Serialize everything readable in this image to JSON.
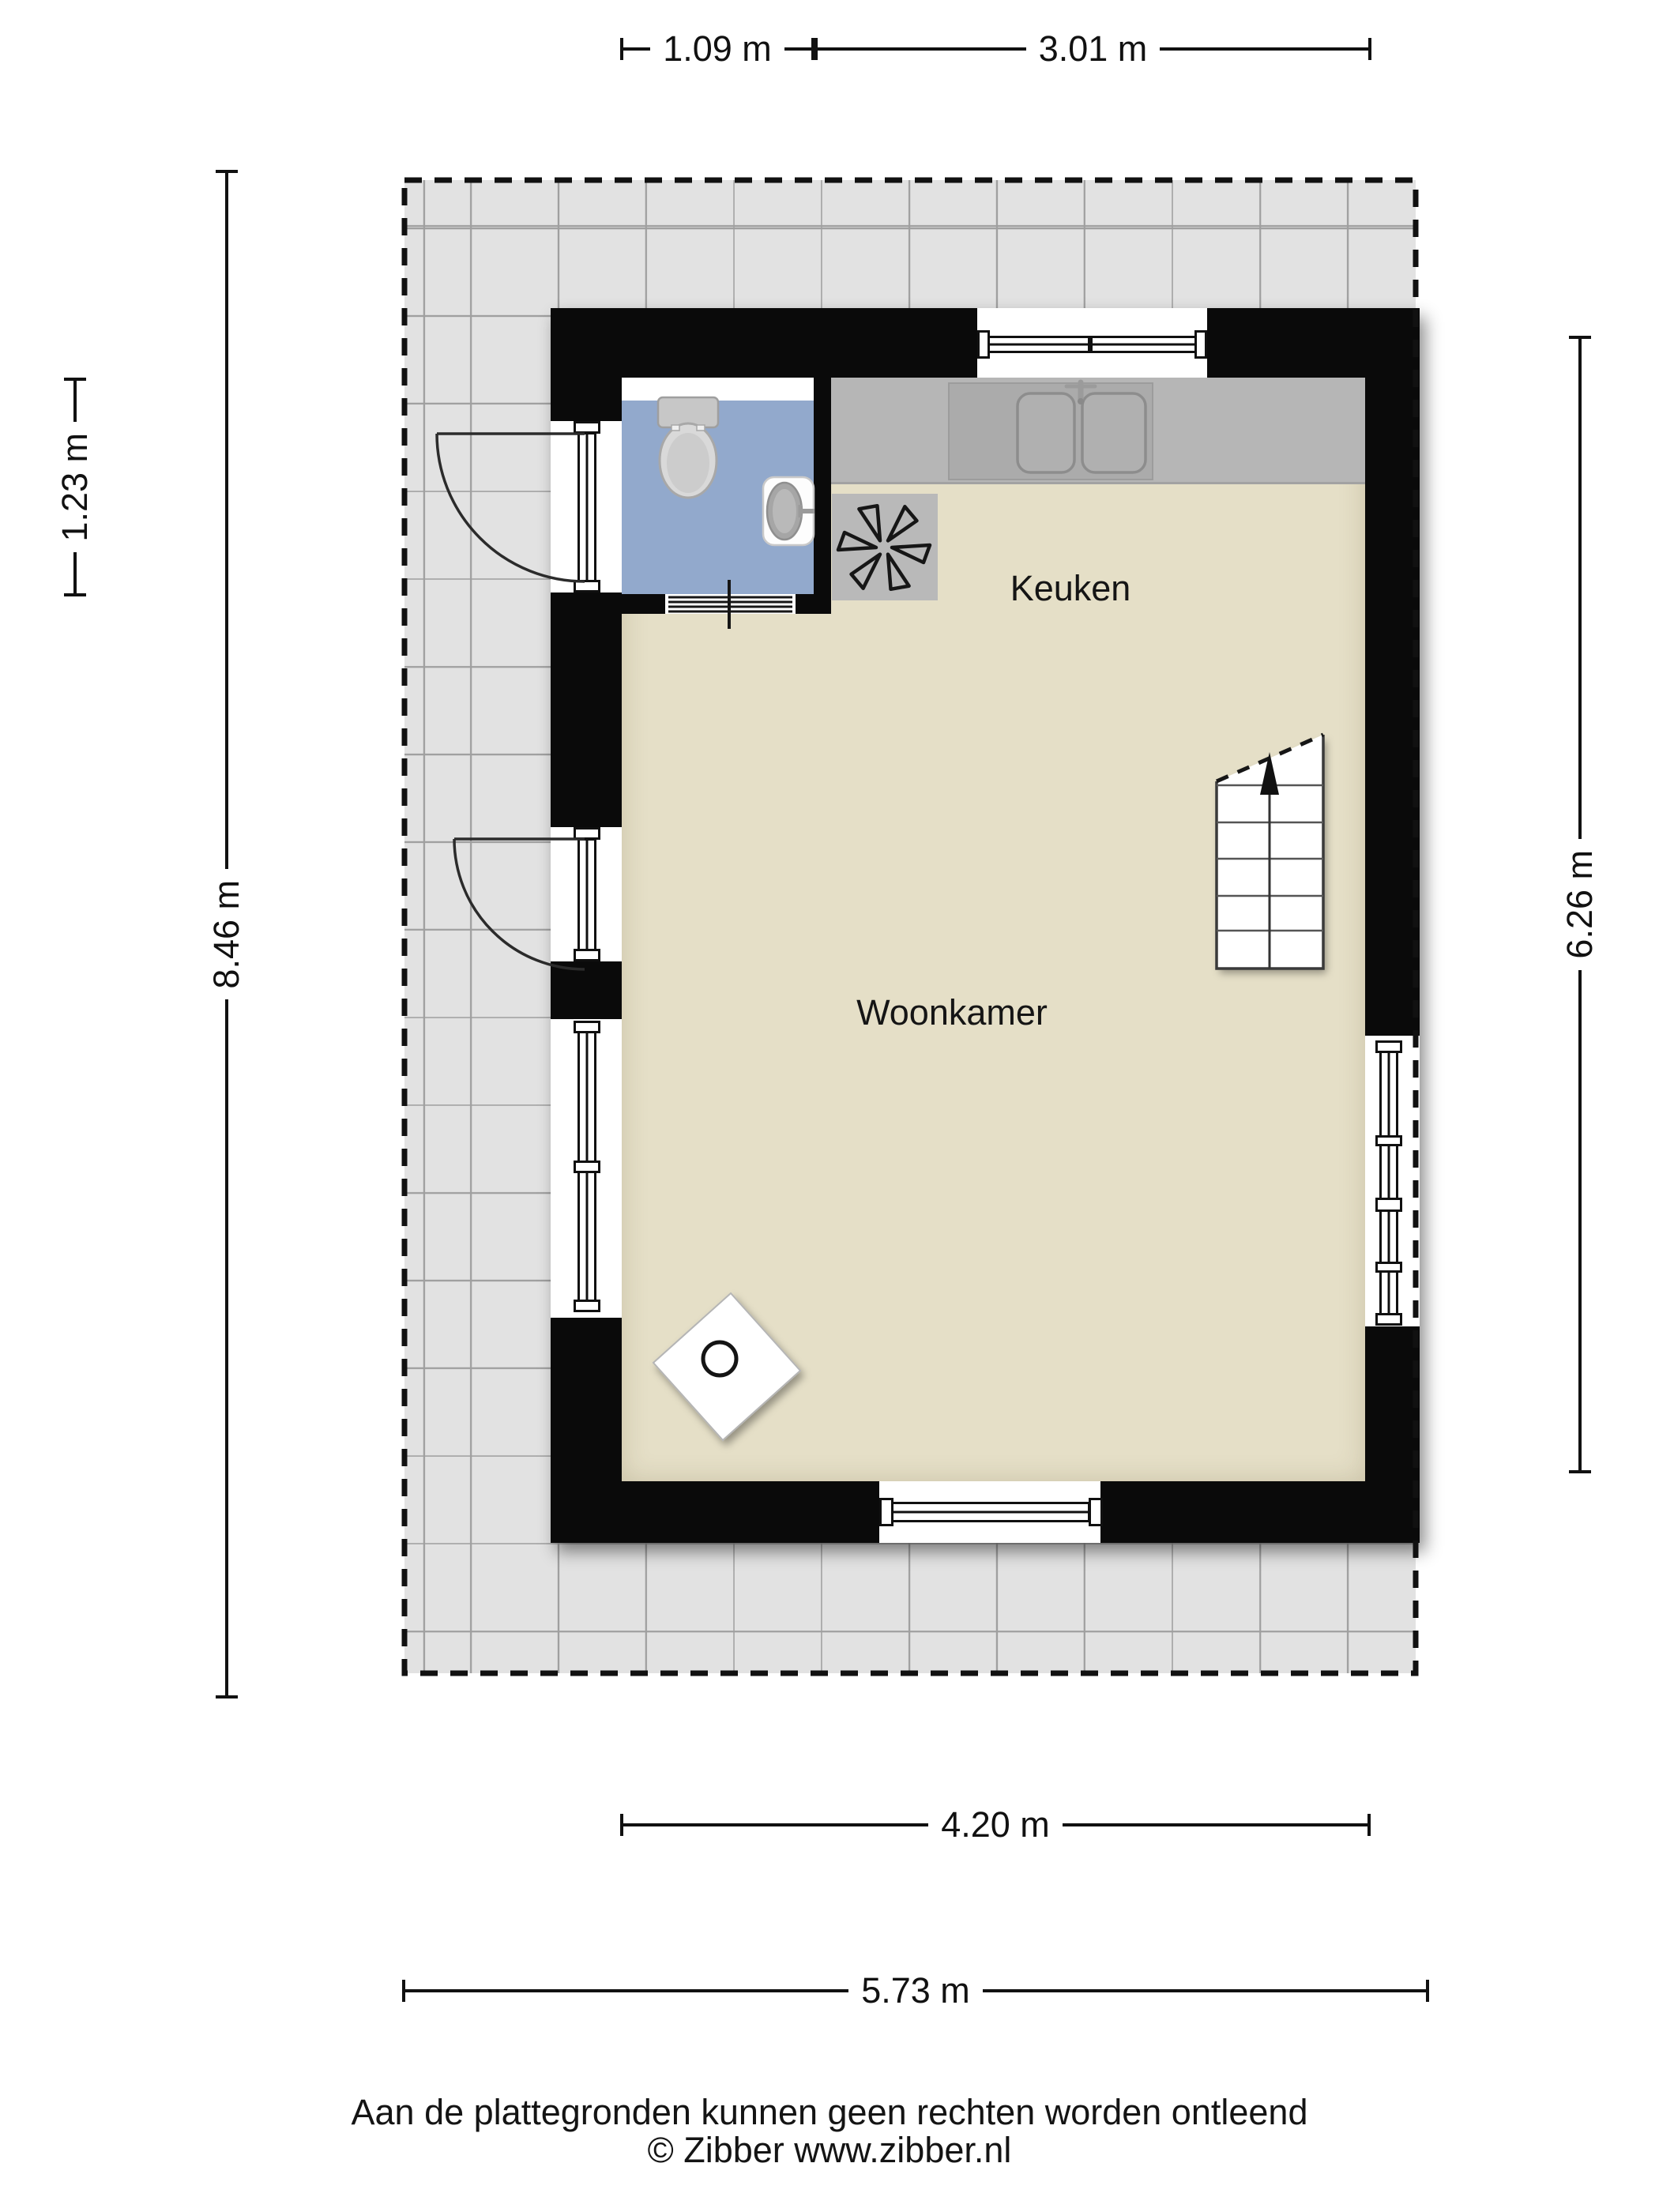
{
  "plan": {
    "type": "floorplan",
    "rooms": {
      "kitchen": "Keuken",
      "living_room": "Woonkamer"
    },
    "fixtures": [
      "toilet",
      "washbasin",
      "kitchen-sink",
      "extractor-fan",
      "stove",
      "staircase"
    ]
  },
  "dimensions": {
    "top_left": "1.09 m",
    "top_right": "3.01 m",
    "left_inner": "1.23 m",
    "left_outer": "8.46 m",
    "right": "6.26 m",
    "bottom_inner": "4.20 m",
    "bottom_outer": "5.73 m"
  },
  "footer": {
    "disclaimer": "Aan de plattegronden kunnen geen rechten worden ontleend",
    "copyright": "© Zibber www.zibber.nl"
  },
  "colors": {
    "wall": "#0a0a0a",
    "floor": "#e5dfc7",
    "bathroom_floor": "#92a9cc",
    "surround_tile": "#e2e2e2",
    "counter": "#b6b6b6",
    "dimension_text": "#111111"
  }
}
